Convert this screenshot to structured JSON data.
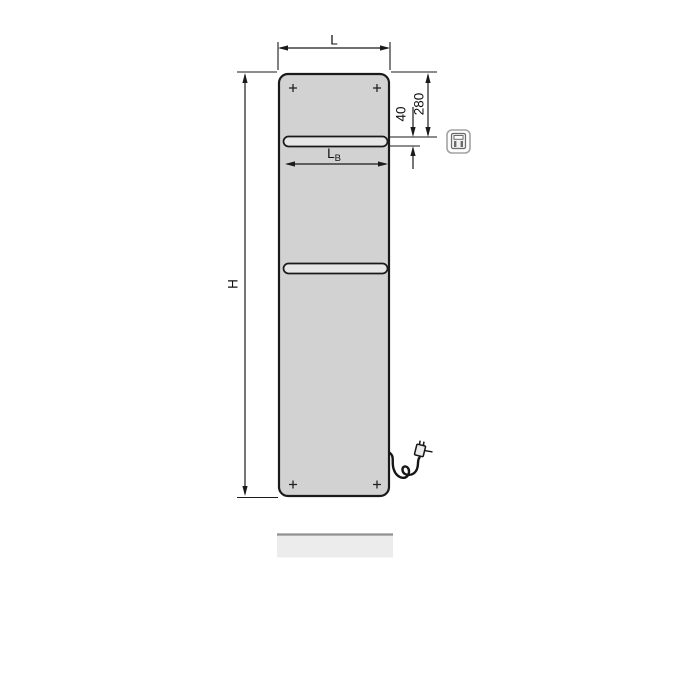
{
  "drawing": {
    "description": "dimension-drawing-of-flat-panel-electric-radiator-front-view",
    "labels": {
      "width": "L",
      "height": "H",
      "rail_width_main": "L",
      "rail_width_sub": "B",
      "top_to_rail": "280",
      "rail_offset": "40"
    },
    "colors": {
      "panel_fill": "#d2d2d2",
      "panel_stroke": "#1a1a1a",
      "slot_fill": "#e7e7e7",
      "dimension_line": "#1a1a1a",
      "shadow_fill": "#ececec",
      "shadow_edge": "#909090",
      "icon_frame": "#a3a3a3",
      "icon_glyph": "#6b6b6b",
      "cord": "#161616"
    },
    "icons": {
      "badge": "electric-plug-icon",
      "corner_marker": "plus-cross-icon"
    }
  }
}
